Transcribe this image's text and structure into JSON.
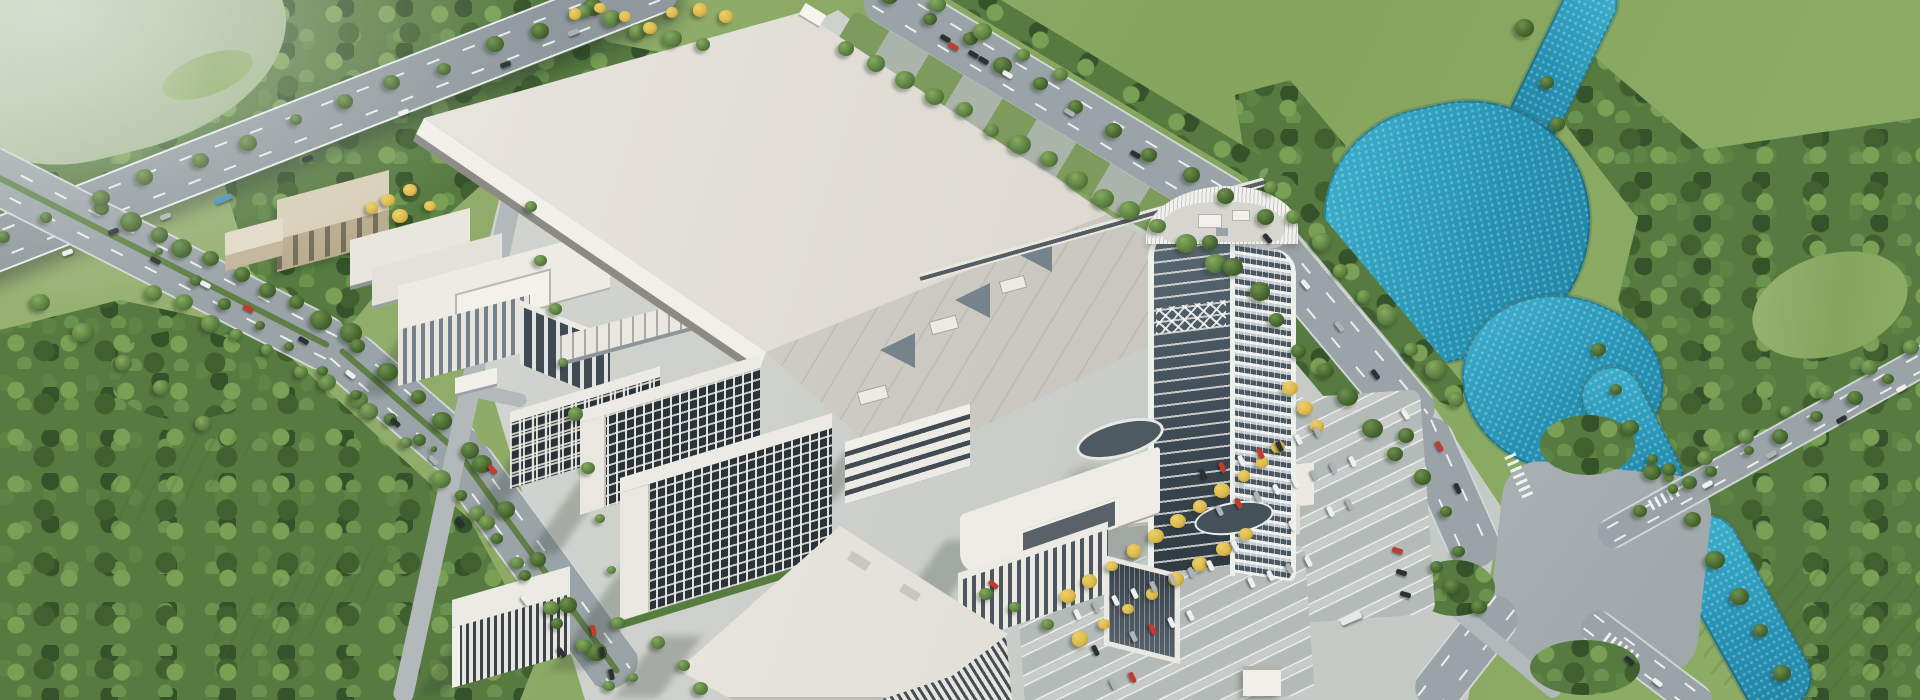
{
  "meta": {
    "domain": "Natural-Image",
    "description": "Photorealistic bird's-eye aerial rendering of a large corporate manufacturing / R&D campus surrounded by tree belts, meadows, curving avenues and a turquoise river. No text, UI chrome or labels are visible anywhere in the image.",
    "width_px": 1920,
    "height_px": 700,
    "visible_text": "none"
  },
  "scene": {
    "title": "Aerial rendering of a corporate manufacturing and R&D campus",
    "time_of_day": "daytime, clear sunlight from upper right",
    "camera": "high oblique aerial (isometric-like) view",
    "regions": {
      "factory": "Huge white flat-roofed production hall occupying the campus center",
      "annex": "Stepped low-rise production annex roofs with vents south-east of the main hall",
      "tower": "High-rise office tower (~25 floors), dark curtain wall with white curved crown",
      "rd_office": "Mid-rise white R&D office block with glass curtain wall at the north-west",
      "lab_wing": "Long narrow lab wing with rooftop frames beside the factory",
      "dormitories": "Three stepped dormitory slabs with dense dark window grids",
      "strip_office": "Four-storey block with horizontal ribbon windows",
      "office_block": "White office block with vertical fins and rounded corner south of the tower",
      "canteen": "Large white-roofed canteen / activity hall with louvered south facade",
      "louver_building": "Low building with vertical louver facade at the campus south edge",
      "aux_buildings": "Small beige auxiliary buildings and long sheds at the north-west corner",
      "gatehouse_sw": "Small white gatehouse at the south-west campus entrance",
      "gatehouse_se": "Small white gatehouse near the south-east parking lot",
      "highway": "Elevated expressway crossing the top-left corner over a tree belt",
      "west_avenue": "Tree-lined boulevard with green median curving along the west side",
      "east_avenue": "Wide multi-lane avenue curving along the east side of the campus",
      "intersection": "Large Y-intersection with zebra crosswalks at the south-east",
      "bridge_road": "Two-lane road branching east across a small river bridge",
      "internal_road": "Internal campus road running along the dormitories",
      "parking_main": "Large surface parking lot with rows of cars and yellow-leaved trees",
      "parking_south": "Second parking field south of the office block",
      "river": "Turquoise river entering top right, widening into a pond, exiting bottom right",
      "meadow_top_right": "Large light-green meadow with scattered trees",
      "forest": "Dense tree belts and forest patches framing the campus",
      "pale_field": "Pale hazy field in the extreme top-left corner",
      "orchard": "Rows of orchard-like trees in the lower-left green belt"
    },
    "palette": {
      "meadow_green": "#8aa968",
      "forest_green": "#4e6e3c",
      "pale_field": "#b7c4aa",
      "asphalt": "#9aa3a7",
      "road_marking": "#eef1f0",
      "campus_paving": "#ced2cd",
      "roof_white": "#e8e5de",
      "facade_white": "#f0efea",
      "glass_dark": "#3e4b55",
      "window_grid_dark": "#2b3238",
      "river_turquoise": "#2f9fc0",
      "autumn_tree_yellow": "#ddb94b",
      "car_red": "#c23b2e",
      "car_dark": "#2c3134",
      "car_white": "#eef0f0",
      "bus_blue": "#3f8fc0"
    },
    "counts": {
      "dormitory_slabs": 3,
      "tower_floors_approx": 25,
      "parking_rows_visible": 7
    }
  }
}
